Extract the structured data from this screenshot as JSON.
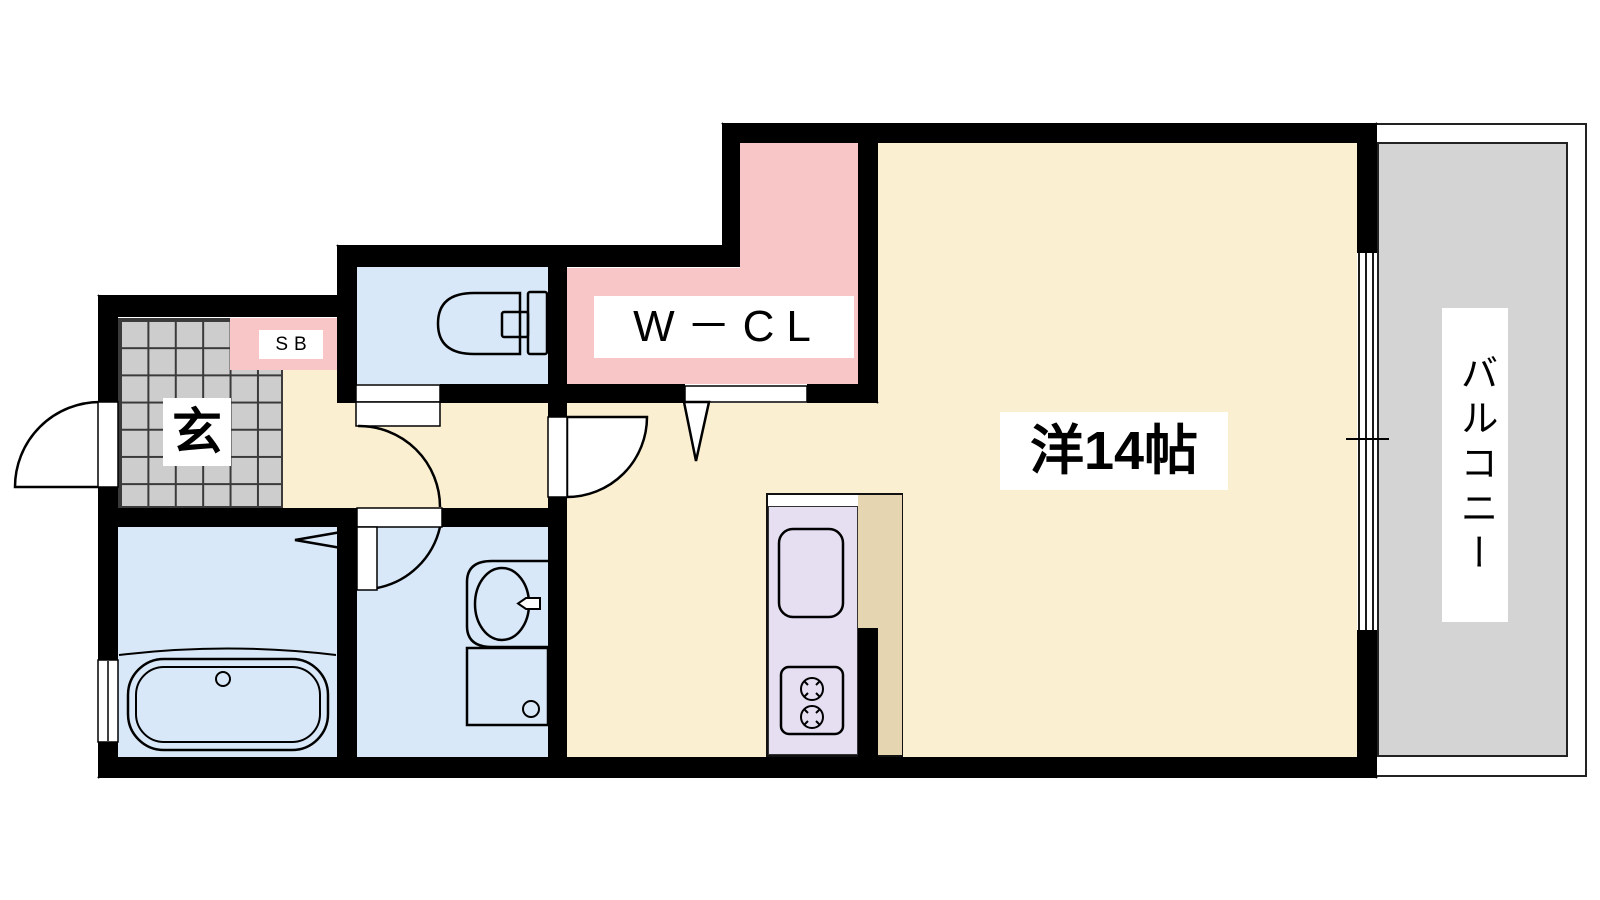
{
  "labels": {
    "entrance": "玄",
    "shoe_box": "SB",
    "walk_in_closet": "W－CL",
    "western_room": "洋14帖",
    "balcony": "バルコニー"
  },
  "colors": {
    "wall": "#000000",
    "room_floor": "#FBEFD2",
    "closet_pink": "#F9C6C7",
    "wet_area_blue": "#D9E8F8",
    "kitchen_counter_purple": "#E6DFF2",
    "kitchen_floor_tan": "#E5D6B1",
    "balcony_gray": "#D4D4D4",
    "entrance_tile_gray": "#CDCDCD"
  },
  "fixtures": {
    "toilet": "toilet-icon",
    "bathtub": "bathtub-icon",
    "washbasin": "washbasin-icon",
    "washing_machine_pan": "washing-machine-icon",
    "kitchen_sink": "kitchen-sink-icon",
    "stove": "stove-icon"
  }
}
